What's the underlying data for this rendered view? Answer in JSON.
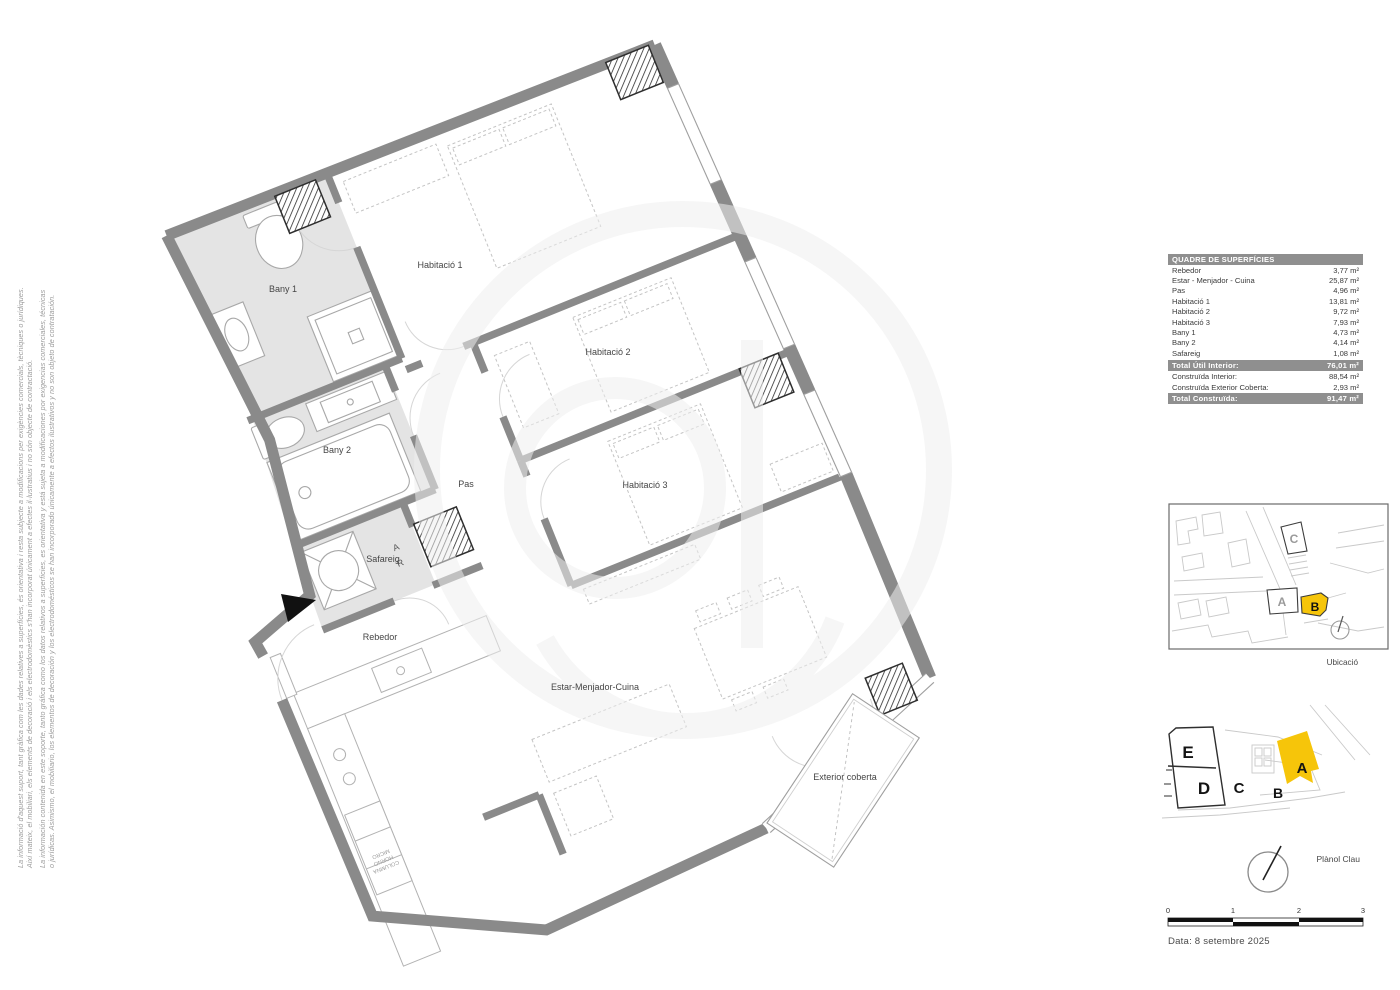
{
  "disclaimer": {
    "ca1": "La informació d'aquest suport, tant gràfica com les dades relatives a superfícies, és orientativa i resta subjecte a modificacions per exigències comercials, tècniques o jurídiques.",
    "ca2": "Així mateix, el mobiliari, els elements de decoració i els electrodomèstics s'han incorporat únicament a efectes il·lustratius i no són objecte de contractació.",
    "es1": "La información contenida en este soporte, tanto gráfica como los datos relativos a superficies, es orientativa y está sujeta a modificaciones por exigencias comerciales, técnicas",
    "es2": "o jurídicas. Asimismo, el mobiliario, los elementos de decoración y los electrodomésticos se han incorporado únicamente a efectos ilustrativos y no son objeto de contratación."
  },
  "plan": {
    "labels": {
      "bany1": "Bany 1",
      "bany2": "Bany 2",
      "hab1": "Habitació 1",
      "hab2": "Habitació 2",
      "hab3": "Habitació 3",
      "pas": "Pas",
      "safareig": "Safareig",
      "rebedor": "Rebedor",
      "estar": "Estar-Menjador-Cuina",
      "exterior": "Exterior coberta"
    },
    "washer": {
      "a": "A",
      "r": "R"
    },
    "appliance": {
      "l1": "COLUMNA",
      "l2": "HORNO",
      "l3": "MICRO"
    },
    "wall_color": "#8a8a8a",
    "bath_floor_color": "#e4e4e4"
  },
  "surface_table": {
    "title": "QUADRE DE SUPERFÍCIES",
    "rows": [
      {
        "label": "Rebedor",
        "value": "3,77 m²"
      },
      {
        "label": "Estar - Menjador - Cuina",
        "value": "25,87 m²"
      },
      {
        "label": "Pas",
        "value": "4,96 m²"
      },
      {
        "label": "Habitació 1",
        "value": "13,81 m²"
      },
      {
        "label": "Habitació 2",
        "value": "9,72 m²"
      },
      {
        "label": "Habitació 3",
        "value": "7,93 m²"
      },
      {
        "label": "Bany 1",
        "value": "4,73 m²"
      },
      {
        "label": "Bany 2",
        "value": "4,14 m²"
      },
      {
        "label": "Safareig",
        "value": "1,08 m²"
      }
    ],
    "total_util": {
      "label": "Total Útil Interior:",
      "value": "76,01 m²"
    },
    "construida": [
      {
        "label": "Construïda Interior:",
        "value": "88,54 m²"
      },
      {
        "label": "Construïda Exterior Coberta:",
        "value": "2,93 m²"
      }
    ],
    "total_constructed": {
      "label": "Total Construïda:",
      "value": "91,47 m²"
    }
  },
  "location_map": {
    "label": "Ubicació",
    "letters": {
      "a": "A",
      "b": "B",
      "c": "C"
    },
    "highlight": "B",
    "highlight_color": "#f6c50a"
  },
  "key_plan": {
    "label": "Plànol Clau",
    "letters": {
      "a": "A",
      "b": "B",
      "c": "C",
      "d": "D",
      "e": "E"
    },
    "highlight": "A",
    "highlight_color": "#f6c50a"
  },
  "scale_bar": {
    "ticks": [
      "0",
      "1",
      "2",
      "3"
    ]
  },
  "footer": {
    "date": "Data: 8 setembre 2025"
  }
}
